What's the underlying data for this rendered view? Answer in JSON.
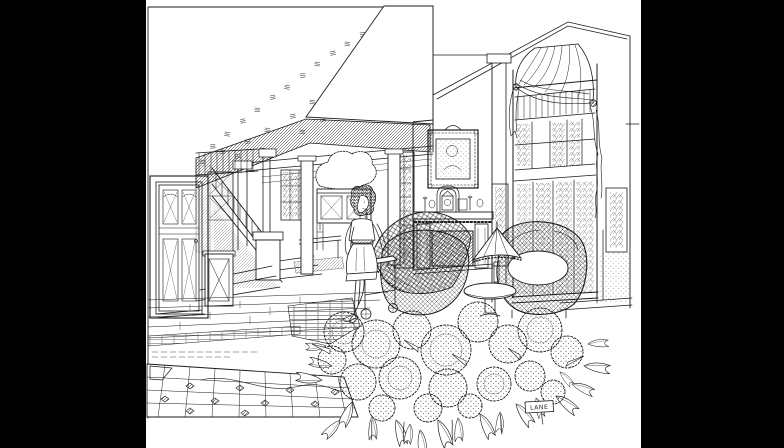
{
  "colors": {
    "matte": "#000000",
    "paper": "#ffffff",
    "ink": "#1b1b1b"
  },
  "artwork": {
    "signature": "LANE"
  },
  "scene": {
    "label": "Pen-and-ink interior illustration of a house: stair hall, fireplace with portrait, tall draped window, wicker chairs, standing woman, hydrangeas in foreground",
    "elements": [
      "paneled-door",
      "staircase",
      "hall-cabinet",
      "dining-room",
      "buffet-plant",
      "woman-figure",
      "tea-cart",
      "plaid-throw",
      "wicker-armchairs",
      "fireplace",
      "portrait-painting",
      "glazed-door",
      "fringed-table-lamp",
      "pedestal-table",
      "tall-window",
      "swag-drapery",
      "sidelight-windows",
      "plank-floor",
      "tile-walkway",
      "hydrangea-bed",
      "artist-signature"
    ]
  }
}
